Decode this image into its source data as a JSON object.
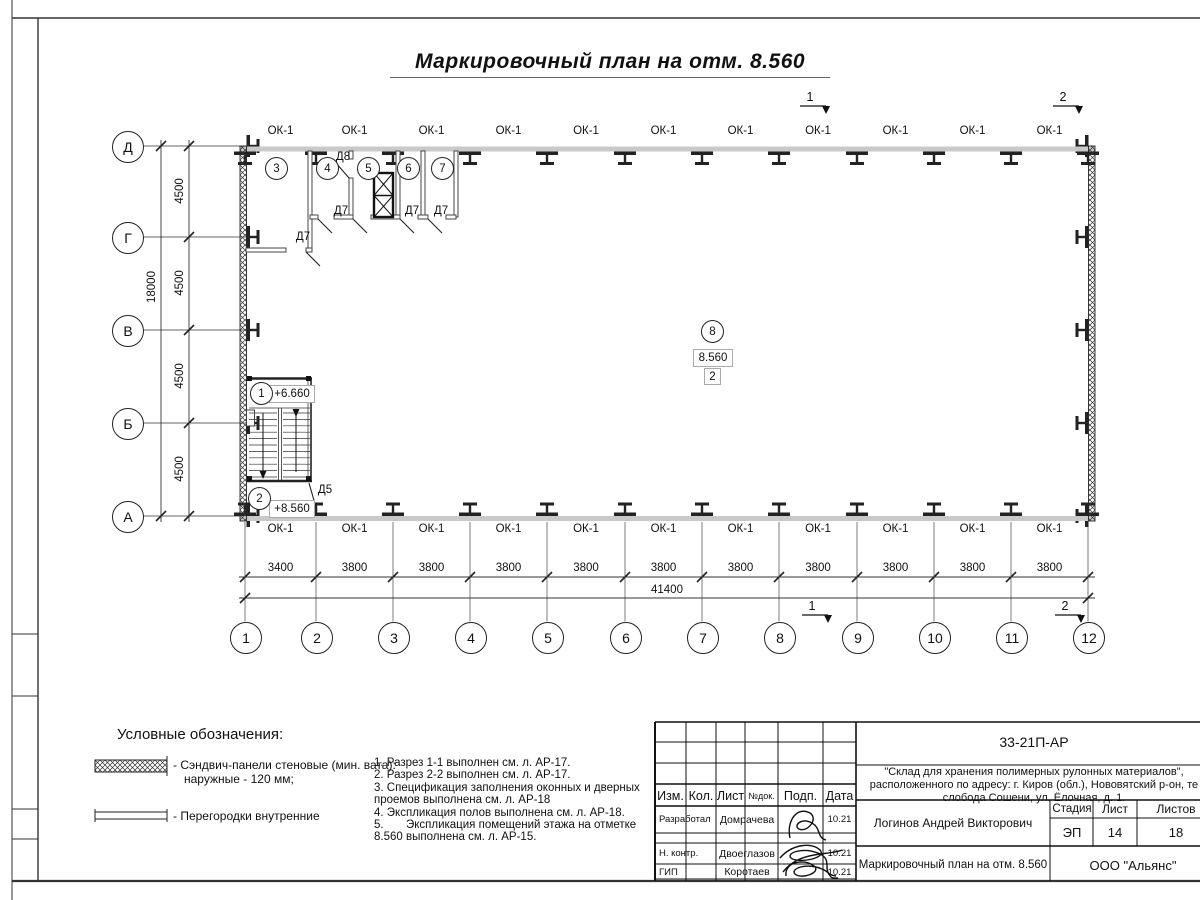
{
  "sheet": {
    "title": "Маркировочный план на отм. 8.560"
  },
  "grid": {
    "rows": [
      "Д",
      "Г",
      "В",
      "Б",
      "А"
    ],
    "cols": [
      "1",
      "2",
      "3",
      "4",
      "5",
      "6",
      "7",
      "8",
      "9",
      "10",
      "11",
      "12"
    ]
  },
  "dimensions": {
    "left_bays": [
      "4500",
      "4500",
      "4500",
      "4500"
    ],
    "left_total": "18000",
    "bottom_bays": [
      "3400",
      "3800",
      "3800",
      "3800",
      "3800",
      "3800",
      "3800",
      "3800",
      "3800",
      "3800",
      "3800"
    ],
    "bottom_total": "41400"
  },
  "plan": {
    "window_label": "ОК-1",
    "rooms": [
      {
        "num": "1",
        "elevation": "+6.660"
      },
      {
        "num": "2",
        "elevation": "+8.560"
      },
      {
        "num": "3"
      },
      {
        "num": "4"
      },
      {
        "num": "5"
      },
      {
        "num": "6"
      },
      {
        "num": "7"
      },
      {
        "num": "8",
        "elevation": "8.560",
        "floor_type": "2"
      }
    ],
    "doors": {
      "d5": "Д5",
      "d7": "Д7",
      "d8": "Д8"
    },
    "sections": [
      "1",
      "2"
    ]
  },
  "legend": {
    "heading": "Условные обозначения:",
    "items": [
      {
        "symbol": "sandwich-panel-hatch",
        "label": "- Сэндвич-панели стеновые (мин. вата):",
        "label2": "наружные - 120 мм;"
      },
      {
        "symbol": "double-line-partition",
        "label": "- Перегородки внутренние"
      }
    ]
  },
  "notes": [
    "1. Разрез 1-1 выполнен см. л. АР-17.",
    "2. Разрез 2-2 выполнен см. л. АР-17.",
    "3. Спецификация заполнения оконных и дверных",
    "проемов выполнена см. л. АР-18",
    "4. Экспликация полов выполнена см. л. АР-18.",
    "5.       Экспликация помещений этажа на отметке",
    "8.560 выполнена см. л. АР-15."
  ],
  "title_block": {
    "doc_number": "33-21П-АР",
    "project_lines": [
      "\"Склад для хранения полимерных рулонных материалов\",",
      "расположенного по адресу: г. Киров (обл.), Нововятский р-он, те",
      "слобода Сошени, ул. Ёлочная, д. 1."
    ],
    "header_cols": [
      "Изм.",
      "Кол.",
      "Лист",
      "№док.",
      "Подп.",
      "Дата"
    ],
    "rows": [
      {
        "role": "Разработал",
        "name": "Домрачева",
        "date": "10.21"
      },
      {
        "role": "Н. контр.",
        "name": "Двоеглазов",
        "date": "10.21"
      },
      {
        "role": "ГИП",
        "name": "Коротаев",
        "date": "10.21"
      }
    ],
    "approver": "Логинов Андрей Викторович",
    "stage_label": "Стадия",
    "sheet_label": "Лист",
    "sheets_label": "Листов",
    "stage": "ЭП",
    "sheet_num": "14",
    "sheets_total": "18",
    "drawing_title": "Маркировочный план на отм. 8.560",
    "company": "ООО \"Альянс\""
  }
}
